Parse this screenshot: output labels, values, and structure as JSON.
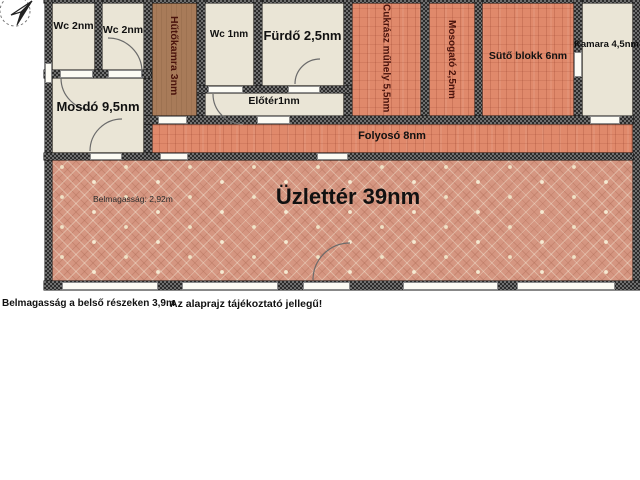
{
  "plan": {
    "icons": {
      "compass": "north-arrow"
    },
    "colors": {
      "wall_dark": "#2b2b2b",
      "wall_light": "#6f6f6f",
      "room_beige": "#eae5d6",
      "room_brown": "#a87b59",
      "room_salmon": "#e0896b",
      "room_terracotta": "#d59681",
      "vertical_label_color": "#4a130c"
    },
    "rooms": {
      "wc_a": {
        "label": "Wc 2nm"
      },
      "wc_b": {
        "label": "Wc 2nm"
      },
      "mosdo": {
        "label": "Mosdó 9,5nm"
      },
      "hutokamra": {
        "label": "Hűtőkamra 3nm"
      },
      "wc_c": {
        "label": "Wc 1nm"
      },
      "furdo": {
        "label": "Fürdő 2,5nm"
      },
      "eloter": {
        "label": "Előtér1nm"
      },
      "cukrasz": {
        "label": "Cukrász műhely 5,5nm"
      },
      "mosogato": {
        "label": "Mosogató 2,5nm"
      },
      "suto": {
        "label": "Sütő blokk 6nm"
      },
      "kamara": {
        "label": "Kamara 4,5nm"
      },
      "folyoso": {
        "label": "Folyosó 8nm"
      },
      "uzletter": {
        "label": "Üzlettér 39nm",
        "ceiling_note": "Belmagasság: 2,92m"
      }
    },
    "captions": {
      "ceiling_height": "Belmagasság a belső részeken 3,9m",
      "disclaimer": "Az alaprajz tájékoztató jellegű!"
    }
  }
}
